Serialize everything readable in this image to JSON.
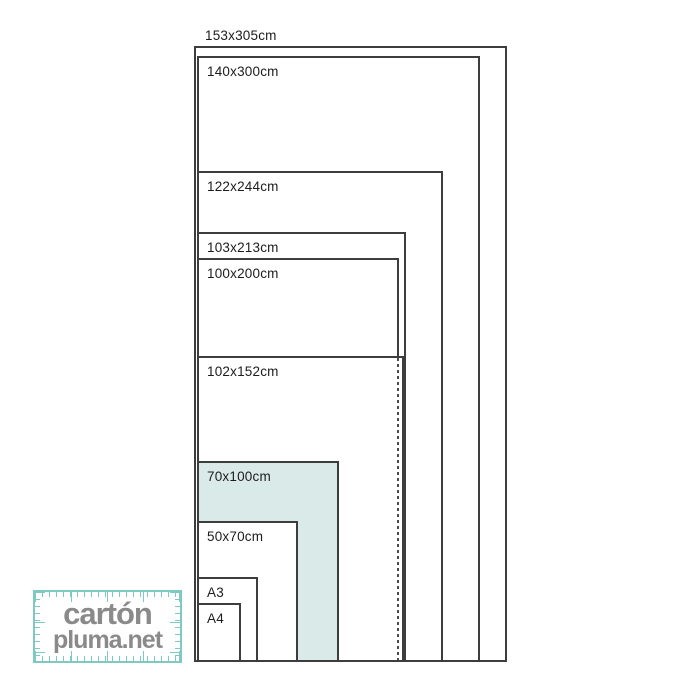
{
  "diagram": {
    "title_implicit": "foam board sheet sizes comparison",
    "line_color": "#3d3d3d",
    "highlight_color": "#d9eae8",
    "sizes": [
      {
        "label": "153x305cm",
        "highlighted": false
      },
      {
        "label": "140x300cm",
        "highlighted": false
      },
      {
        "label": "122x244cm",
        "highlighted": false
      },
      {
        "label": "103x213cm",
        "highlighted": false
      },
      {
        "label": "100x200cm",
        "highlighted": false
      },
      {
        "label": "102x152cm",
        "highlighted": false
      },
      {
        "label": "70x100cm",
        "highlighted": true
      },
      {
        "label": "50x70cm",
        "highlighted": false
      },
      {
        "label": "A3",
        "highlighted": false
      },
      {
        "label": "A4",
        "highlighted": false
      }
    ]
  },
  "logo": {
    "line1": "cartón",
    "line2": "pluma.net",
    "text_color": "#8a8a8a",
    "frame_color": "#7fc9c3"
  }
}
